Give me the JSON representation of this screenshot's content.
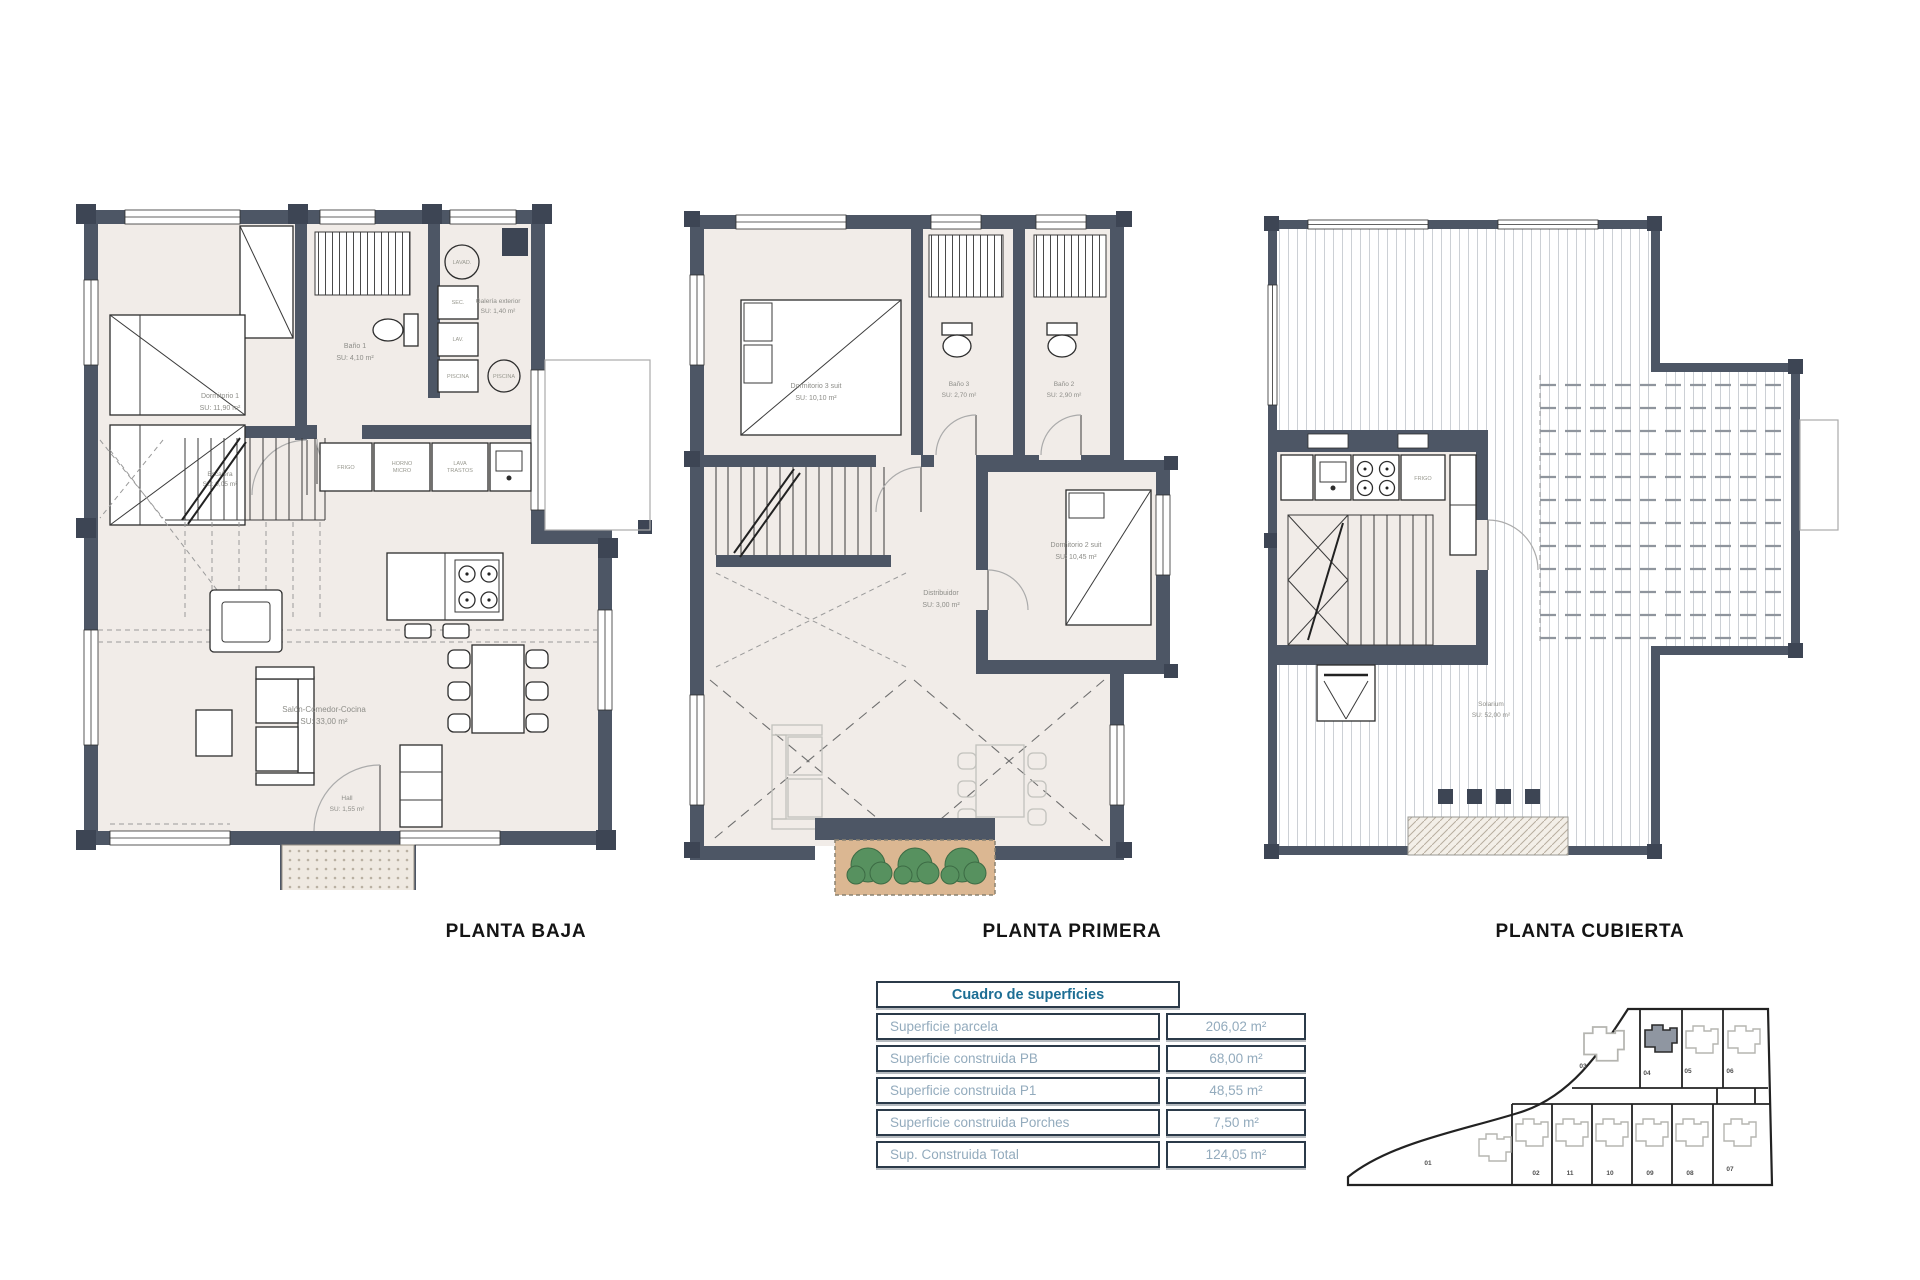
{
  "titles": {
    "baja": "PLANTA BAJA",
    "primera": "PLANTA PRIMERA",
    "cubierta": "PLANTA CUBIERTA"
  },
  "planta_baja": {
    "dormitorio1_name": "Dormitorio 1",
    "dormitorio1_area": "SU: 11,90 m²",
    "bano1_name": "Baño 1",
    "bano1_area": "SU: 4,10 m²",
    "galeria_name": "Galería exterior",
    "galeria_area": "SU: 1,40 m²",
    "escalera_name": "Escalera",
    "escalera_area": "SU: 9,05 m²",
    "salon_name": "Salón-Comedor-Cocina",
    "salon_area": "SU: 33,00 m²",
    "hall_name": "Hall",
    "hall_area": "SU: 1,55 m²",
    "app_frigo": "FRIGO",
    "app_horno1": "HORNO",
    "app_horno2": "MICRO",
    "app_lava1": "LAVA",
    "app_lava2": "TRASTOS",
    "gal_lavad": "LAVAD.",
    "gal_sec": "SEC.",
    "gal_lav": "LAV.",
    "gal_piscina_box": "PISCINA",
    "gal_piscina_circ": "PISCINA"
  },
  "planta_primera": {
    "dormitorio3_name": "Dormitorio 3 suit",
    "dormitorio3_area": "SU: 10,10 m²",
    "bano3_name": "Baño 3",
    "bano3_area": "SU: 2,70 m²",
    "bano2_name": "Baño 2",
    "bano2_area": "SU: 2,90 m²",
    "dormitorio2_name": "Dormitorio 2 suit",
    "dormitorio2_area": "SU: 10,45 m²",
    "distribuidor_name": "Distribuidor",
    "distribuidor_area": "SU: 3,00 m²"
  },
  "planta_cubierta": {
    "solarium_name": "Solarium",
    "solarium_area": "SU: 52,00 m²",
    "app_frigo": "FRIGO"
  },
  "table": {
    "title": "Cuadro de superficies",
    "rows": [
      {
        "label": "Superficie parcela",
        "value": "206,02 m²"
      },
      {
        "label": "Superficie construida PB",
        "value": "68,00 m²"
      },
      {
        "label": "Superficie construida P1",
        "value": "48,55 m²"
      },
      {
        "label": "Superficie construida Porches",
        "value": "7,50 m²"
      },
      {
        "label": "Sup. Construida Total",
        "value": "124,05 m²"
      }
    ]
  },
  "siteplan": {
    "plots": {
      "p01": "01",
      "p02": "02",
      "p03": "03",
      "p04": "04",
      "p05": "05",
      "p06": "06",
      "p07": "07",
      "p08": "08",
      "p09": "09",
      "p10": "10",
      "p11": "11"
    },
    "highlighted": "04"
  },
  "colors": {
    "wall": "#4d5665",
    "room_fill": "#f1ece8",
    "table_border": "#2b3a49",
    "table_title": "#1d6e94",
    "table_text": "#93abbd",
    "plant_green": "#57915f",
    "planter_soil": "#dbb792"
  }
}
